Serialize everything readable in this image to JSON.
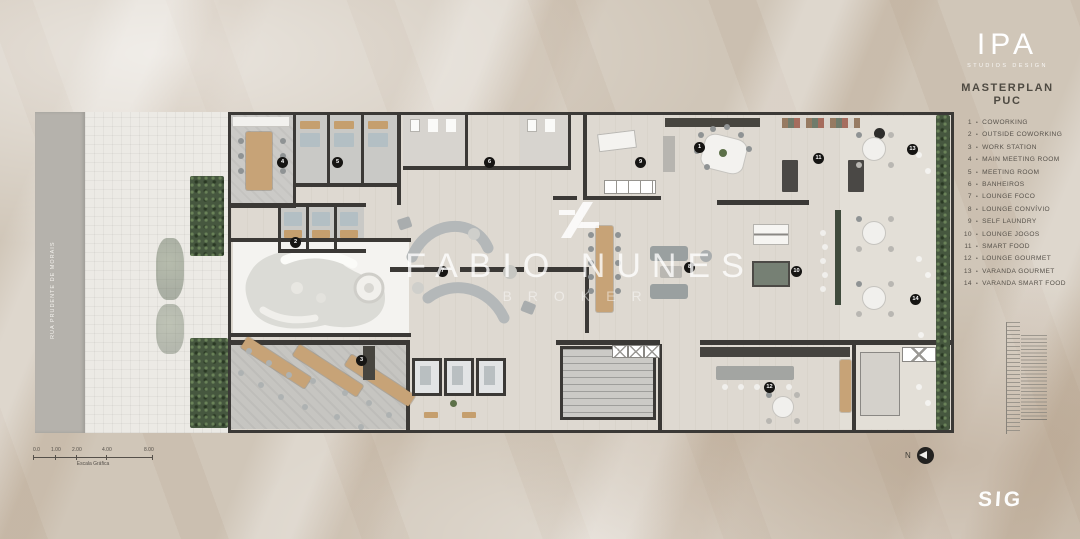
{
  "header": {
    "brand": "IPA",
    "brand_tagline": "STUDIOS DESIGN",
    "title": "MASTERPLAN",
    "subtitle": "PUC"
  },
  "legend": {
    "separator": "•",
    "items": [
      {
        "num": "1",
        "label": "COWORKING"
      },
      {
        "num": "2",
        "label": "OUTSIDE COWORKING"
      },
      {
        "num": "3",
        "label": "WORK STATION"
      },
      {
        "num": "4",
        "label": "MAIN MEETING ROOM"
      },
      {
        "num": "5",
        "label": "MEETING ROOM"
      },
      {
        "num": "6",
        "label": "BANHEIROS"
      },
      {
        "num": "7",
        "label": "LOUNGE FOCO"
      },
      {
        "num": "8",
        "label": "LOUNGE CONVÍVIO"
      },
      {
        "num": "9",
        "label": "SELF LAUNDRY"
      },
      {
        "num": "10",
        "label": "LOUNGE JOGOS"
      },
      {
        "num": "11",
        "label": "SMART FOOD"
      },
      {
        "num": "12",
        "label": "LOUNGE GOURMET"
      },
      {
        "num": "13",
        "label": "VARANDA GOURMET"
      },
      {
        "num": "14",
        "label": "VARANDA SMART FOOD"
      }
    ]
  },
  "plan": {
    "street_label": "RUA PRUDENTE DE MORAIS",
    "markers": [
      "1",
      "2",
      "3",
      "4",
      "5",
      "6",
      "7",
      "8",
      "9",
      "10",
      "11",
      "12",
      "13",
      "14"
    ]
  },
  "watermark": {
    "name": "FABIO NUNES",
    "subtitle": "BROKER"
  },
  "scale_bar": {
    "labels": [
      "0.0",
      "1.00",
      "2.00",
      "4.00",
      "8.00"
    ],
    "caption": "Escala Gráfica"
  },
  "compass": {
    "label": "N"
  },
  "footer": {
    "logo": "SIG"
  },
  "palette": {
    "background": "#d0c6b8",
    "wall": "#3b3936",
    "hedge_green": "#46573f",
    "wood": "#c7a377",
    "marker_black": "#161513",
    "logo_white": "#ffffff"
  }
}
